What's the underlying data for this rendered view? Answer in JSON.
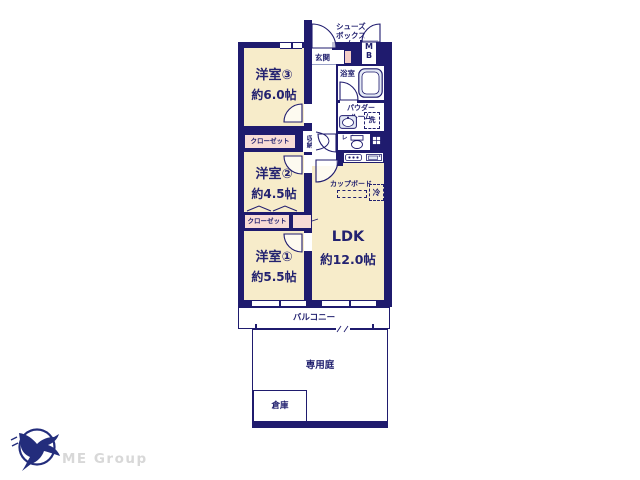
{
  "colors": {
    "wall": "#1f1b6e",
    "text": "#232270",
    "room": "#f7ecca",
    "closet": "#f8dcd6",
    "shoebox": "#f3cdc6",
    "fixture": "#e4e9f5",
    "step": "#9aa2c8",
    "logo_text": "#d8d8d8",
    "logo": "#232d7c"
  },
  "rooms": {
    "room3": {
      "name": "洋室③",
      "size": "約6.0帖"
    },
    "room2": {
      "name": "洋室②",
      "size": "約4.5帖"
    },
    "room1": {
      "name": "洋室①",
      "size": "約5.5帖"
    },
    "ldk": {
      "name": "LDK",
      "size": "約12.0帖"
    }
  },
  "labels": {
    "entrance": "玄関",
    "shoes_box": [
      "シューズ",
      "ボックス"
    ],
    "mb": [
      "M",
      "B"
    ],
    "bathroom": "浴室",
    "powder_room": [
      "パウダー",
      "ルーム"
    ],
    "laundry": "洗",
    "toilet": "トイレ",
    "storage": "収納",
    "closet": "クローゼット",
    "closet_wrapped": [
      "クロー",
      "ゼット"
    ],
    "cupboard": "カップボード",
    "fridge": "冷",
    "balcony": "バルコニー",
    "private_garden": "専用庭",
    "shed": "倉庫"
  },
  "logo": {
    "company": "ME Group"
  }
}
